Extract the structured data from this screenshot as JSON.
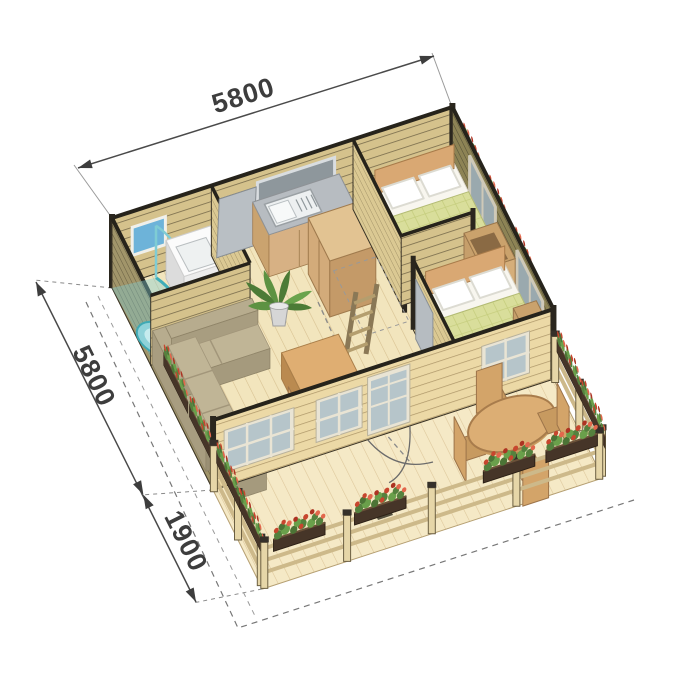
{
  "diagram": {
    "type": "isometric-cabin-floor-plan",
    "background": "#ffffff",
    "dimensions": {
      "width": "5800",
      "depth": "5800",
      "terrace_depth": "1900"
    },
    "rooms": [
      "bathroom",
      "kitchen",
      "living-room",
      "bedroom-1",
      "bedroom-2",
      "terrace"
    ],
    "furniture": [
      "shower",
      "washbasin",
      "kitchen-sink-counter",
      "tall-cabinet",
      "double-bed-1",
      "double-bed-2",
      "wardrobe-1",
      "wardrobe-2",
      "corner-sofa",
      "coffee-table",
      "desk",
      "desk-chair",
      "potted-plant",
      "loft-ladder",
      "round-dining-table",
      "dining-chairs",
      "flower-boxes"
    ],
    "colors": {
      "wall_light": "#d5c28c",
      "wall_front": "#ecd9a6",
      "wall_dark": "#8d8355",
      "wall_left": "#a1956a",
      "floor": "#f2e5bd",
      "deck": "#f5e9c6",
      "bed_cover": "#d9de9b",
      "shower": "#7fccd4",
      "counter": "#b7bcc1",
      "wood_furniture": "#dfae72",
      "sofa": "#b7ac8e",
      "flowers_red": "#c7462e",
      "foliage": "#55813e",
      "dimension_text": "#3d3d3d"
    }
  }
}
